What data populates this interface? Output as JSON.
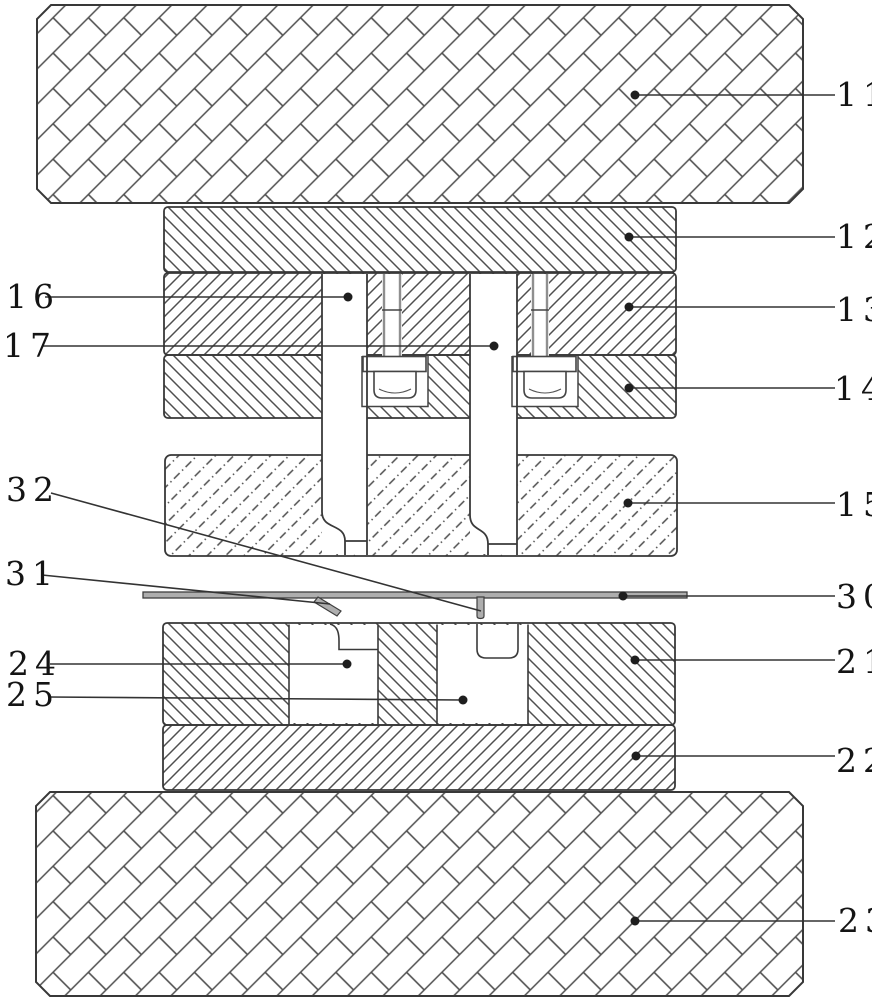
{
  "figure": {
    "kind": "patent cross-section diagram of a stamping die assembly",
    "background_color": "#ffffff",
    "line_color": "#383838",
    "hatch_color": "#4f4f4f",
    "strip_fill_color": "#aeaeae",
    "callouts": {
      "c11": "11",
      "c12": "12",
      "c13": "13",
      "c14": "14",
      "c15": "15",
      "c16": "16",
      "c17": "17",
      "c21": "21",
      "c22": "22",
      "c23": "23",
      "c24": "24",
      "c25": "25",
      "c30": "30",
      "c31": "31",
      "c32": "32"
    }
  }
}
